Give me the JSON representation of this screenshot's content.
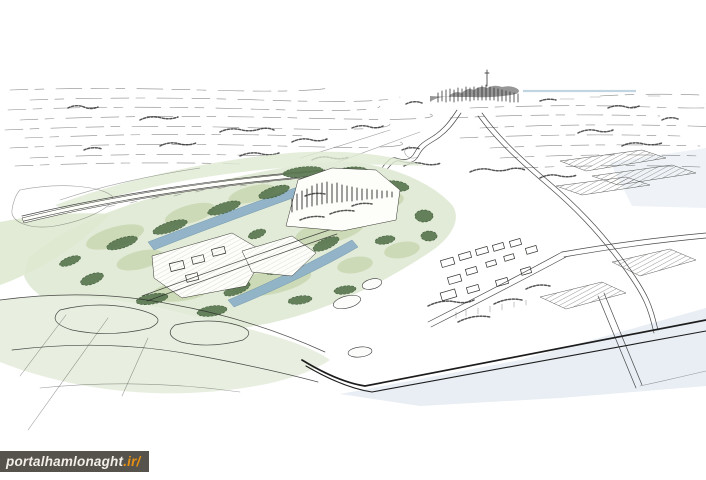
{
  "figure": {
    "kind": "hand-drawn aerial perspective masterplan sketch",
    "elements": [
      "distant-field-lines",
      "distant-city-skyline",
      "winding-river",
      "green-masterplan-site",
      "water-channels",
      "tree-clusters",
      "tower-district",
      "low-building-clusters",
      "dike-road",
      "village",
      "hatched-field-plots",
      "bold-foreground-road",
      "pale-blue-washes",
      "foreground-field-boundaries"
    ]
  },
  "watermark": {
    "text": "portalhamlonaght",
    "suffix": ".ir/"
  },
  "colors": {
    "paper": "#ffffff",
    "ink": "#2b2b2b",
    "site_green": "#e2ebd7",
    "field_green": "#e8efe0",
    "band_green": "#dfe9d2",
    "patch_green": "#c9d7b2",
    "tree_green": "#5a7750",
    "tree_edge": "#3e5838",
    "water_blue": "#8fb2c8",
    "water_edge": "#6e93aa",
    "wash_blue": "#e2eaf1",
    "horizon_blue": "#b7cddd",
    "road_dark": "#1d1d1d",
    "wm_bg": "#56524c",
    "wm_text": "#f3efe8",
    "wm_accent": "#e89110"
  }
}
